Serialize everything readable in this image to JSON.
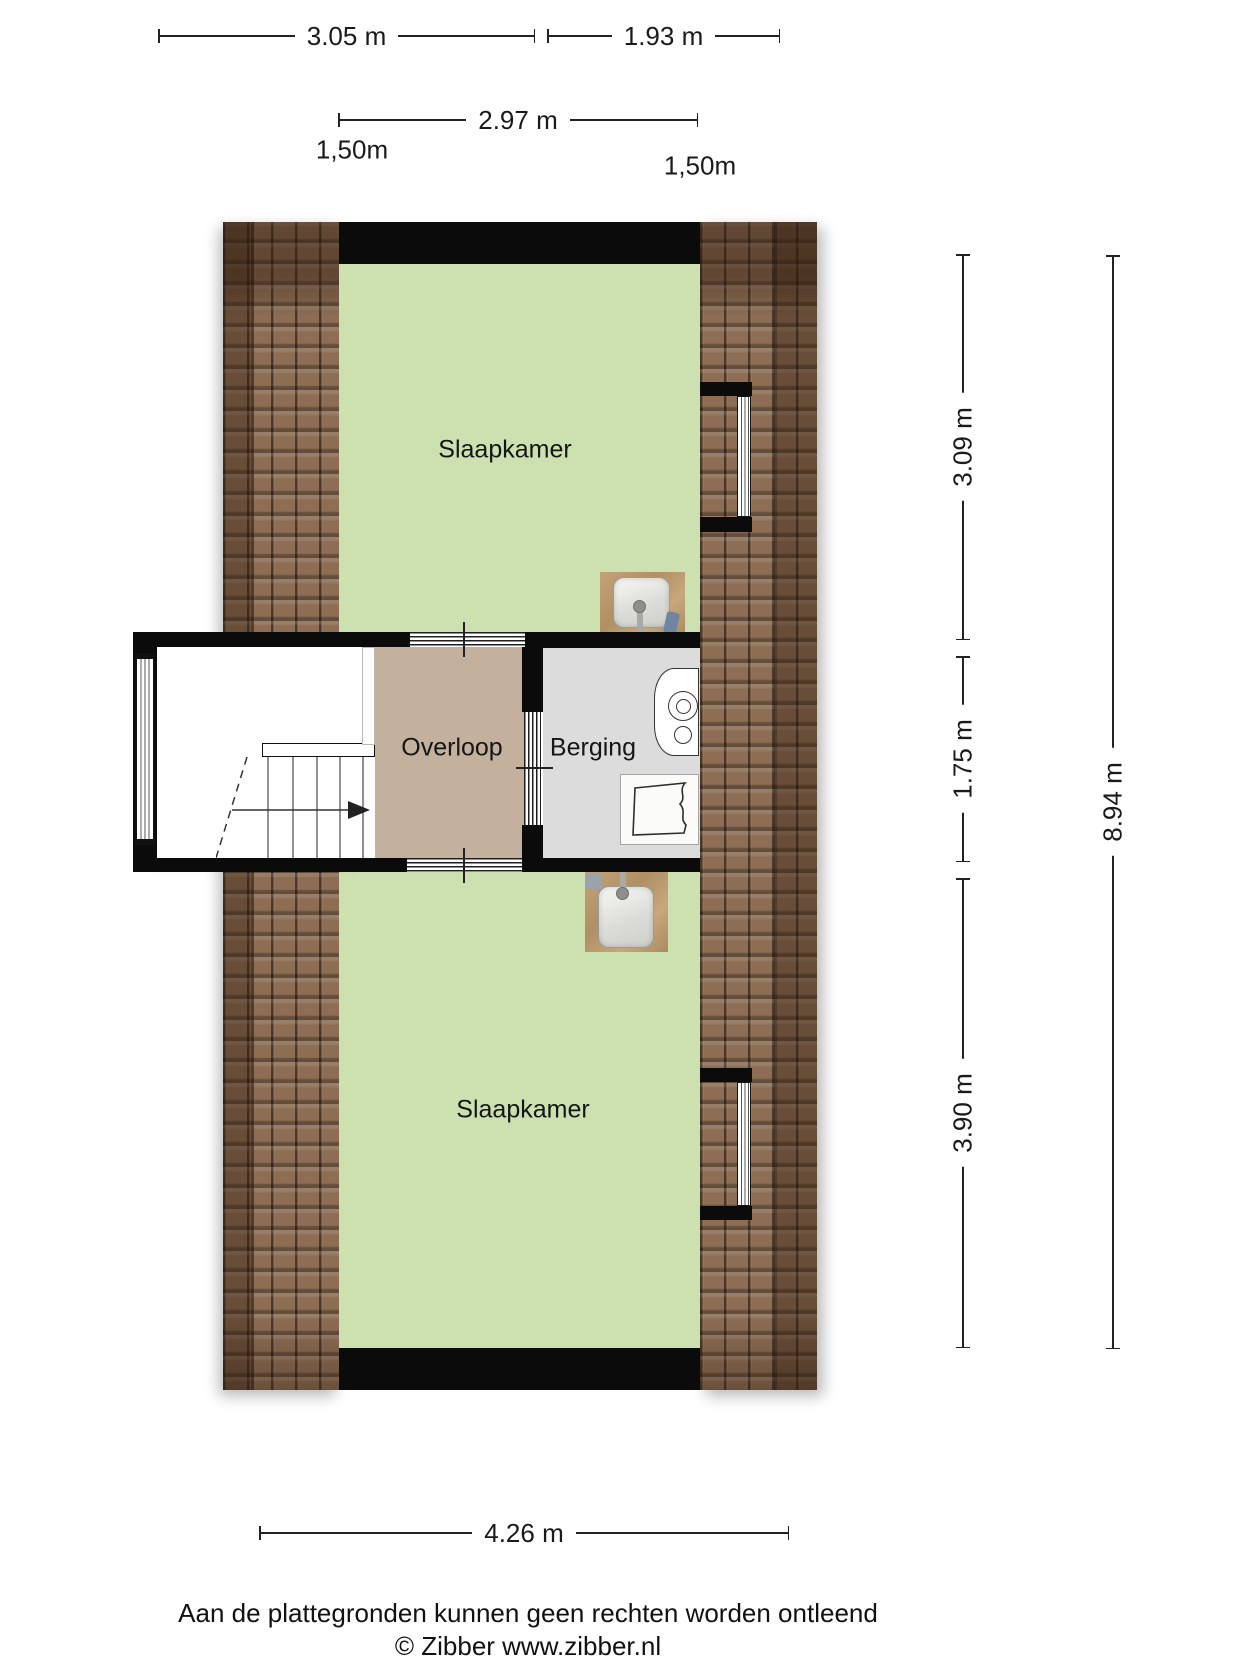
{
  "floorplan": {
    "rooms": [
      {
        "id": "bedroom-top",
        "label": "Slaapkamer"
      },
      {
        "id": "landing",
        "label": "Overloop"
      },
      {
        "id": "storage",
        "label": "Berging"
      },
      {
        "id": "bedroom-bottom",
        "label": "Slaapkamer"
      }
    ],
    "fixtures": [
      {
        "icon": "sink-icon",
        "location": "bedroom-top"
      },
      {
        "icon": "sink-icon",
        "location": "bedroom-bottom"
      },
      {
        "icon": "washing-machine-icon",
        "location": "storage"
      },
      {
        "icon": "laundry-basket-icon",
        "location": "storage"
      },
      {
        "icon": "staircase-icon",
        "location": "landing"
      },
      {
        "icon": "stairs-direction-arrow-icon",
        "location": "landing"
      },
      {
        "icon": "window-icon",
        "count": 3
      },
      {
        "icon": "roof-tiles-texture",
        "count": 2
      }
    ]
  },
  "dimensions": {
    "top_row": [
      {
        "label": "3.05 m"
      },
      {
        "label": "1.93 m"
      }
    ],
    "width_inner": {
      "label": "2.97 m"
    },
    "knee_wall_heights": [
      {
        "label": "1,50m"
      },
      {
        "label": "1,50m"
      }
    ],
    "right_inner": [
      {
        "label": "3.09 m"
      },
      {
        "label": "1.75 m"
      },
      {
        "label": "3.90 m"
      }
    ],
    "right_outer": {
      "label": "8.94 m"
    },
    "bottom": {
      "label": "4.26 m"
    }
  },
  "footer": {
    "disclaimer": "Aan de plattegronden kunnen geen rechten worden ontleend",
    "copyright": "© Zibber www.zibber.nl"
  },
  "colors": {
    "room-green": "#cde1b0",
    "landing-tan": "#c3b19d",
    "storage-gray": "#dcdcdc",
    "wall": "#0b0b0b",
    "roof-base": "#96755a",
    "wood": "#b99d72",
    "dim": "#222222",
    "text": "#1a1a1a"
  }
}
